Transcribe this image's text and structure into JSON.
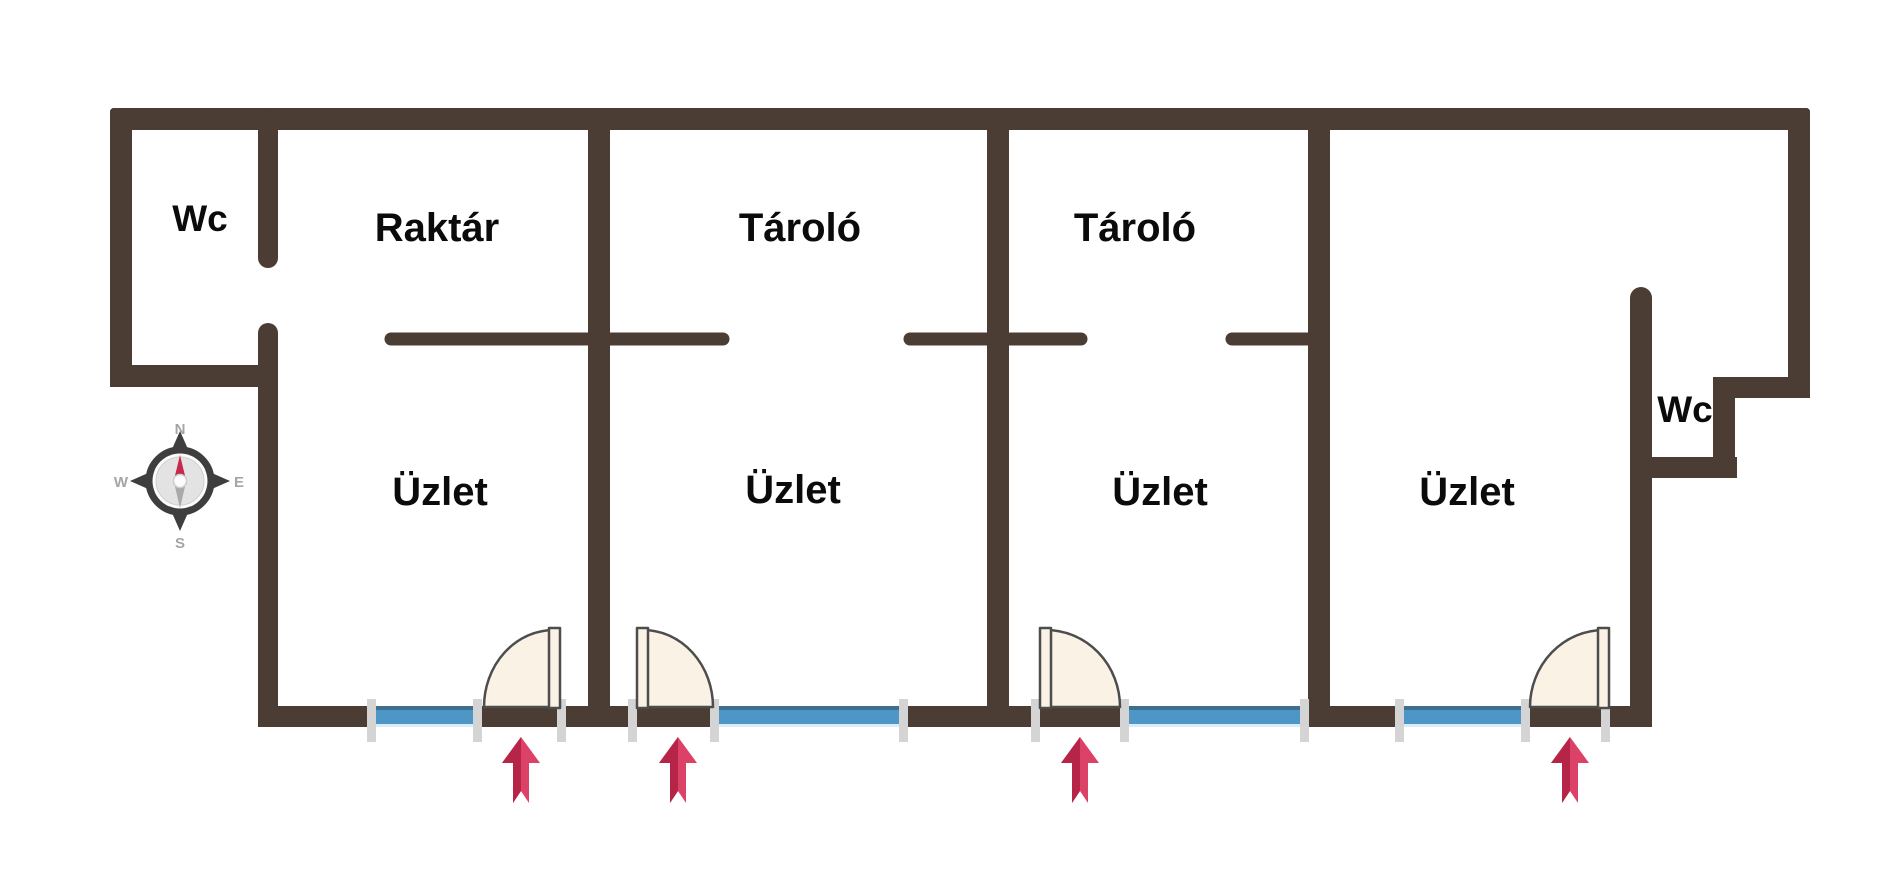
{
  "rooms": [
    {
      "id": "wc-left",
      "label": "Wc"
    },
    {
      "id": "raktar",
      "label": "Raktár"
    },
    {
      "id": "tarolo-1",
      "label": "Tároló"
    },
    {
      "id": "tarolo-2",
      "label": "Tároló"
    },
    {
      "id": "uzlet-1",
      "label": "Üzlet"
    },
    {
      "id": "uzlet-2",
      "label": "Üzlet"
    },
    {
      "id": "uzlet-3",
      "label": "Üzlet"
    },
    {
      "id": "uzlet-4",
      "label": "Üzlet"
    },
    {
      "id": "wc-right",
      "label": "Wc"
    }
  ],
  "compass": {
    "north": "N",
    "east": "E",
    "south": "S",
    "west": "W"
  },
  "colors": {
    "background": "#ffffff",
    "wall": "#4b3d34",
    "window_blue": "#4d96c5",
    "window_top": "#3d6f8e",
    "window_bottom": "#d9edf8",
    "door_fill": "#faf2e4",
    "door_outline": "#4d4d4d",
    "jamb": "#d4d4d4",
    "arrow_light": "#dc4168",
    "arrow_dark": "#b62448",
    "compass_dark": "#3e3e3e",
    "compass_inner": "#e3e3e3",
    "compass_inner_edge": "#cfcfcf",
    "compass_white": "#fbfbfb",
    "compass_letters": "#a5a5a5",
    "needle_north": "#c32a4c",
    "needle_south": "#a9a9a9",
    "label_text": "#0b0b0b"
  }
}
